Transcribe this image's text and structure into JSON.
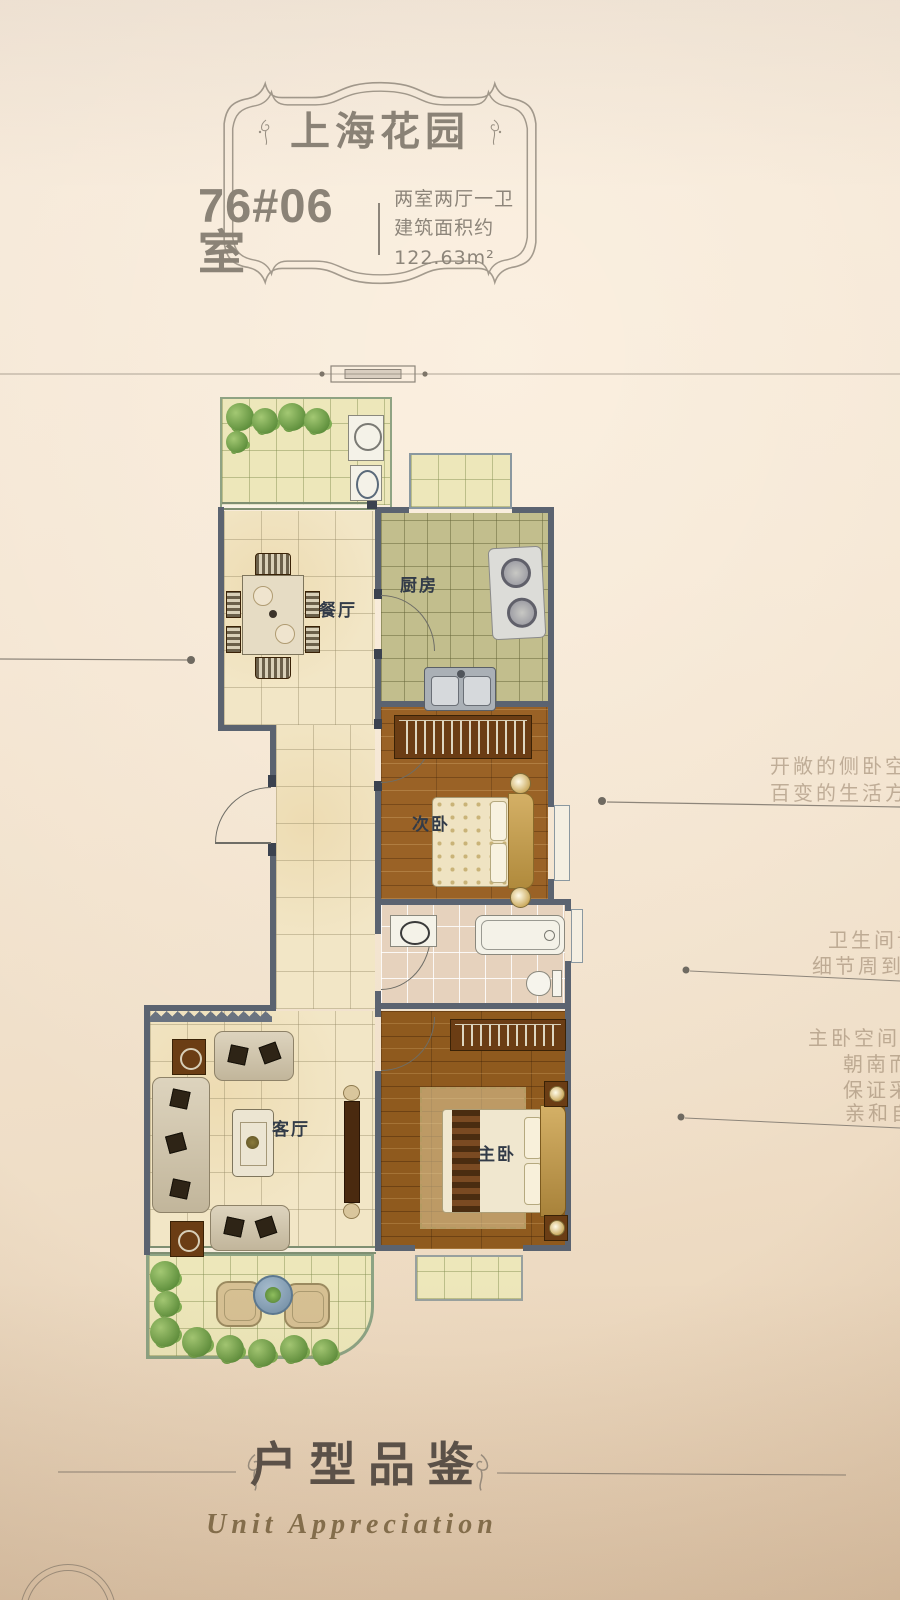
{
  "plaque": {
    "project_name": "上海花园",
    "unit_number": "76#06室",
    "layout_type": "两室两厅一卫",
    "area": "建筑面积约122.63m²"
  },
  "rooms": {
    "dining": "餐厅",
    "kitchen": "厨房",
    "bedroom2": "次卧",
    "living": "客厅",
    "master": "主卧"
  },
  "callouts": {
    "right1": [
      "开敞的侧卧空",
      "百变的生活方"
    ],
    "right2": [
      "卫生间设",
      "细节周到考"
    ],
    "right3": [
      "主卧空间开",
      "朝南而",
      "保证采",
      "亲和自"
    ]
  },
  "footer": {
    "title_cn": "户型品鉴",
    "title_en": "Unit Appreciation"
  },
  "colors": {
    "paper": "#f3e6d4",
    "wall": "#5b6370",
    "window_frame": "#7f8f72",
    "wood_floor": "#9a6226",
    "label_text": "#323b48",
    "plaque_text": "#8b8377",
    "annotation": "#8d857a"
  }
}
